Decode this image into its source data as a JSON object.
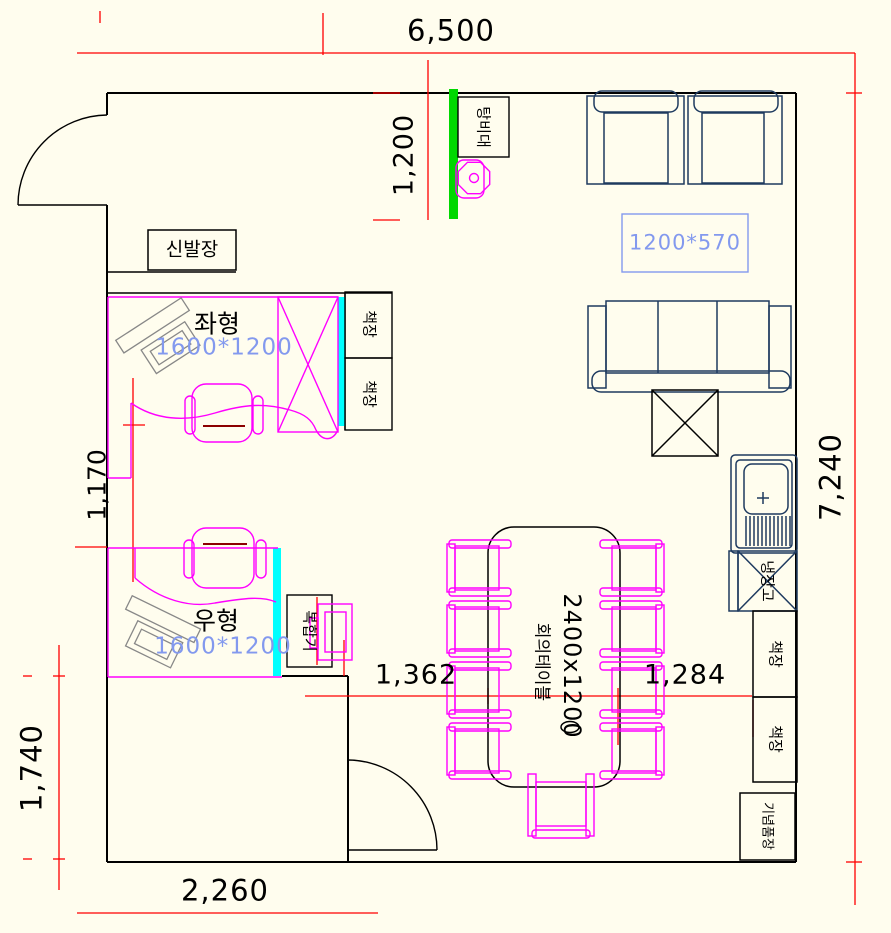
{
  "canvas": {
    "background": "#FFFDEE"
  },
  "colors": {
    "wall": "#000000",
    "furniture_navy": "#1E3A5F",
    "desk_magenta": "#FF00FF",
    "dimension_red": "#FF0000",
    "partition_green": "#00D800",
    "partition_cyan": "#00FFFF",
    "size_text_blue": "#8399EE",
    "seat_accent": "#8B0000"
  },
  "dimensions": {
    "overall_width": "6,500",
    "overall_height": "7,240",
    "pantry_depth": "1,200",
    "desk_gap": "1,170",
    "lower_left_height": "1,740",
    "entry_width": "2,260",
    "table_left_gap": "1,362",
    "table_right_gap": "1,284"
  },
  "furniture": {
    "shoe_cabinet": "신발장",
    "pantry_counter": "탕비대",
    "bookshelf": "책장",
    "left_desk": {
      "type": "좌형",
      "size": "1600*1200"
    },
    "right_desk": {
      "type": "우형",
      "size": "1600*1200"
    },
    "console_size_box": "1200*570",
    "meeting_table": {
      "size": "2400x1200",
      "name": "회의테이블"
    },
    "printer": "복합기",
    "refrigerator": "냉장고",
    "souvenir_cabinet": "기념품장"
  }
}
